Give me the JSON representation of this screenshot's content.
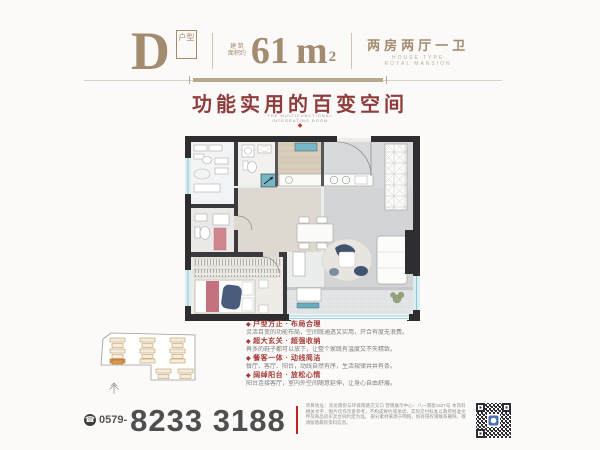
{
  "colors": {
    "accent_tan": "#a28b6e",
    "title_maroon": "#8e3c3c",
    "feature_red": "#a53838",
    "divider_red": "#c42121",
    "phone_gray": "#4f4f4f"
  },
  "header": {
    "type_letter": "D",
    "type_box": "户型",
    "area_label_line1": "建 筑",
    "area_label_line2": "面积约",
    "area_value": "61",
    "area_unit": "m",
    "area_sup": "2",
    "rooms_label": "两房两厅一卫",
    "rooms_sub_line1": "HOUSE TYPE",
    "rooms_sub_line2": "ROYAL MANSION"
  },
  "hero": {
    "title": "功能实用的百变空间",
    "subtitle_line1": "THE MULTIFUNCTIONAL",
    "subtitle_line2": "INTEGRATING ROOM",
    "ornament": "◆"
  },
  "features": {
    "bullet": "◆",
    "items": [
      {
        "title": "户型方正 · 布局合理",
        "desc": "灵活百变的功能布局，空间既通透又实用，开合有度无浪费。"
      },
      {
        "title": "超大玄关 · 超强收纳",
        "desc": "再多的鞋子都可以放下，让整个家既有温度又不失精致。"
      },
      {
        "title": "餐客一体 · 动线简洁",
        "desc": "餐厅、客厅、阳台，动线自然有序，生活规律井井有条。"
      },
      {
        "title": "阔绰阳台 · 放松心情",
        "desc": "阳台连接客厅，室内外空间随意延伸，让身心自由舒展。"
      }
    ]
  },
  "contact": {
    "phone_icon": "☎",
    "area_code": "0579-",
    "number": "8233 3188",
    "disclaimer_lines": [
      "项目地址：双龙南街与环城南路交叉口 营销展示中心：八一南街1527号",
      "本资料相关文字、图片仅作示意参考，不构成要约或承诺，实际交付标准以政府批准文件及商品房买卖合同约定为准。",
      "部分素材来源于网络，如有侵权请联系删除，敬请留意最新资料信息。"
    ]
  }
}
